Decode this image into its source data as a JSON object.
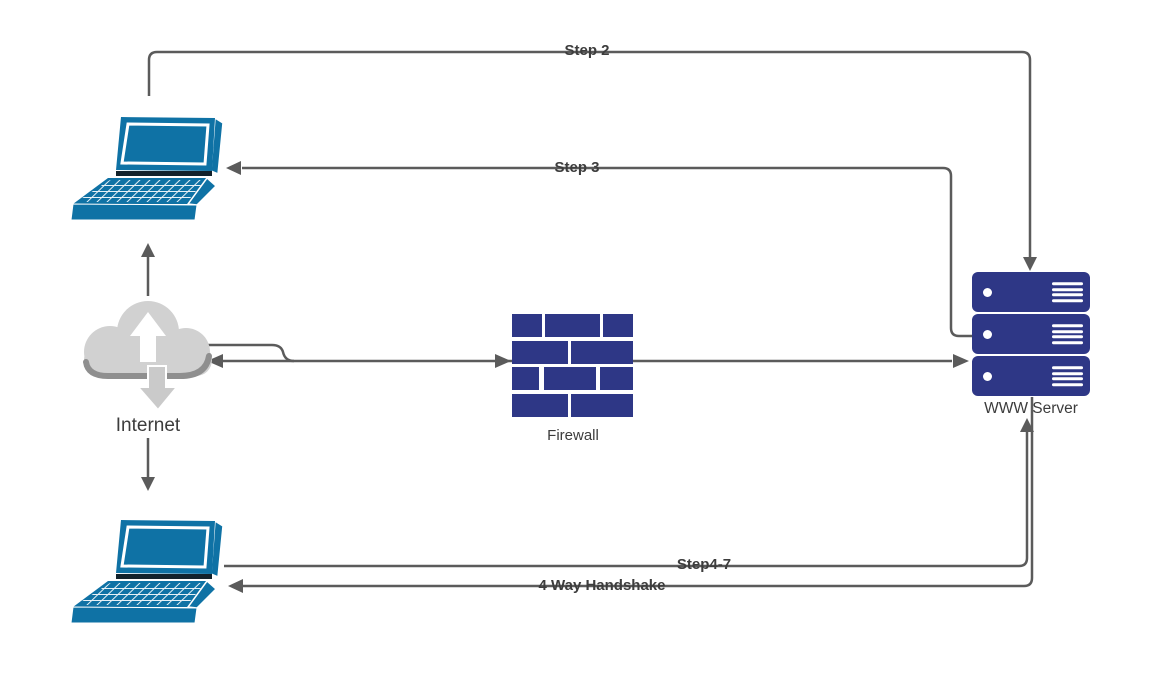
{
  "diagram": {
    "type": "network-flow-diagram",
    "background": "#ffffff",
    "nodes": {
      "laptop_top": {
        "icon": "laptop-icon",
        "label": ""
      },
      "internet": {
        "icon": "cloud-up-down-arrows-icon",
        "label": "Internet"
      },
      "firewall": {
        "icon": "brick-wall-icon",
        "label": "Firewall"
      },
      "www_server": {
        "icon": "server-stack-icon",
        "label": "WWW Server"
      },
      "laptop_bottom": {
        "icon": "laptop-icon",
        "label": ""
      }
    },
    "connectors": {
      "step2": {
        "label": "Step 2",
        "from": "laptop_top",
        "to": "www_server"
      },
      "step3": {
        "label": "Step 3",
        "from": "www_server",
        "to": "laptop_top"
      },
      "internet_uplink": {
        "label": "",
        "from": "internet",
        "to": "laptop_top"
      },
      "internet_downlink": {
        "label": "",
        "from": "internet",
        "to": "laptop_bottom"
      },
      "internet_to_server": {
        "label": "",
        "from": "internet",
        "to": "www_server",
        "via": "firewall"
      },
      "step4_7": {
        "label": "Step4-7",
        "from": "laptop_bottom",
        "to": "www_server"
      },
      "handshake": {
        "label": "4 Way Handshake",
        "from": "www_server",
        "to": "laptop_bottom"
      }
    },
    "colors": {
      "device_blue": "#0f72a5",
      "node_navy": "#2e3786",
      "cloud_gray": "#d1d1d1",
      "cloud_shadow": "#8f8f8f",
      "connector_gray": "#5b5b5b",
      "label_color": "#3c3c3c"
    }
  }
}
